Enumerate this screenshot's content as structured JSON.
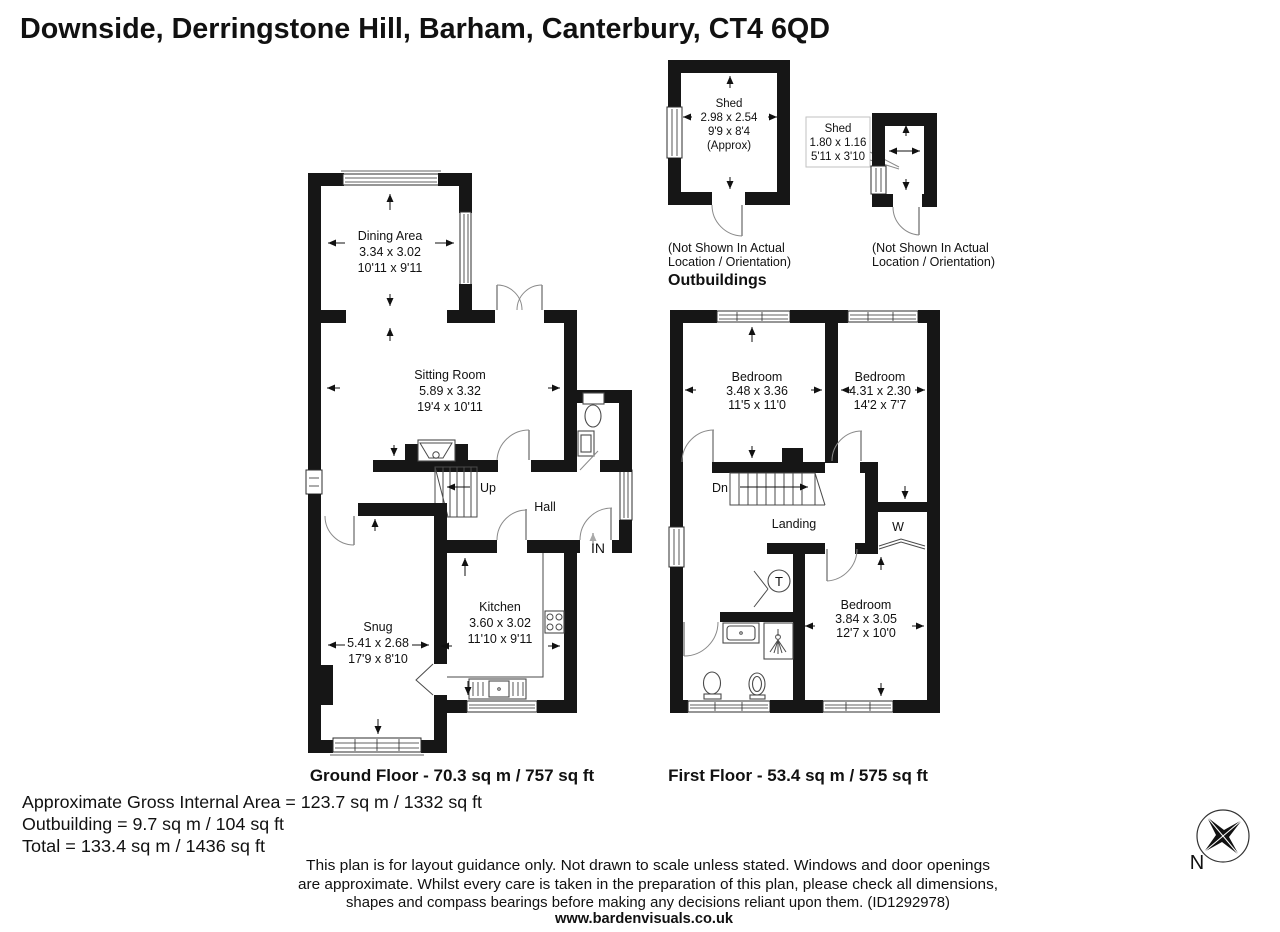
{
  "title": "Downside, Derringstone Hill, Barham, Canterbury, CT4 6QD",
  "outbuildings": {
    "heading": "Outbuildings",
    "shed1": {
      "name": "Shed",
      "dim_m": "2.98 x 2.54",
      "dim_ft": "9'9 x 8'4",
      "approx": "(Approx)",
      "note1": "(Not Shown In Actual",
      "note2": "Location / Orientation)"
    },
    "shed2": {
      "name": "Shed",
      "dim_m": "1.80 x 1.16",
      "dim_ft": "5'11 x 3'10",
      "note1": "(Not Shown In Actual",
      "note2": "Location / Orientation)"
    }
  },
  "ground_floor": {
    "caption": "Ground Floor - 70.3 sq m / 757 sq ft",
    "rooms": {
      "dining": {
        "name": "Dining Area",
        "dim_m": "3.34 x 3.02",
        "dim_ft": "10'11 x 9'11"
      },
      "sitting": {
        "name": "Sitting Room",
        "dim_m": "5.89 x 3.32",
        "dim_ft": "19'4 x 10'11"
      },
      "snug": {
        "name": "Snug",
        "dim_m": "5.41 x 2.68",
        "dim_ft": "17'9 x 8'10"
      },
      "kitchen": {
        "name": "Kitchen",
        "dim_m": "3.60 x 3.02",
        "dim_ft": "11'10 x 9'11"
      },
      "hall": {
        "name": "Hall"
      }
    },
    "labels": {
      "up": "Up",
      "entrance": "IN"
    }
  },
  "first_floor": {
    "caption": "First Floor - 53.4 sq m / 575 sq ft",
    "rooms": {
      "bedroom1": {
        "name": "Bedroom",
        "dim_m": "3.48 x 3.36",
        "dim_ft": "11'5 x 11'0"
      },
      "bedroom2": {
        "name": "Bedroom",
        "dim_m": "4.31 x 2.30",
        "dim_ft": "14'2 x 7'7"
      },
      "bedroom3": {
        "name": "Bedroom",
        "dim_m": "3.84 x 3.05",
        "dim_ft": "12'7 x 10'0"
      },
      "landing": {
        "name": "Landing"
      }
    },
    "labels": {
      "dn": "Dn",
      "wardrobe": "W",
      "tank": "T"
    }
  },
  "areas": {
    "gross": "Approximate Gross Internal Area = 123.7 sq m / 1332 sq ft",
    "outbuilding": "Outbuilding = 9.7 sq m / 104 sq ft",
    "total": "Total = 133.4 sq m / 1436 sq ft"
  },
  "disclaimer": {
    "line1": "This plan is for layout guidance only. Not drawn to scale unless stated. Windows and door openings",
    "line2": "are approximate. Whilst every care is taken in the preparation of this plan, please check all dimensions,",
    "line3": "shapes and compass bearings before making any decisions reliant upon them. (ID1292978)",
    "website": "www.bardenvisuals.co.uk"
  },
  "compass": {
    "north_label": "N"
  },
  "colors": {
    "wall": "#161616",
    "background": "#ffffff"
  }
}
